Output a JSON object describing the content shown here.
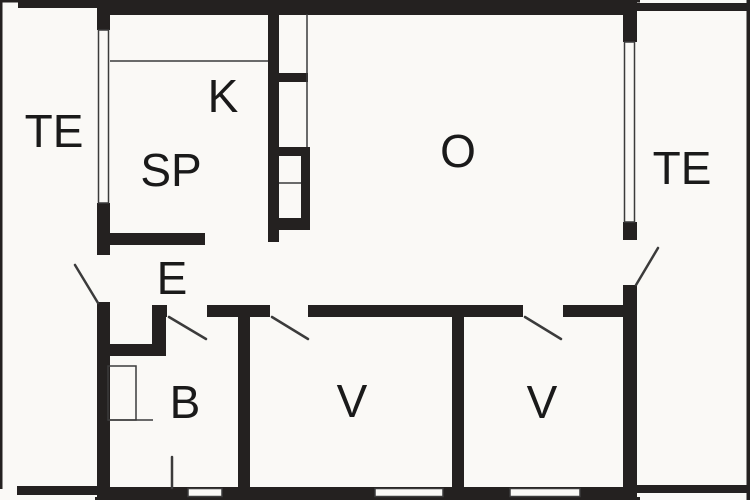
{
  "title": "Floor plan",
  "colors": {
    "background": "#faf9f6",
    "wall": "#242120",
    "line": "#3b3b3b",
    "label": "#1a1a1a"
  },
  "rooms": [
    {
      "id": "terrace-left",
      "label": "TE",
      "x": 54,
      "y": 131
    },
    {
      "id": "kitchen",
      "label": "K",
      "x": 223,
      "y": 96
    },
    {
      "id": "bedroom-sp",
      "label": "SP",
      "x": 171,
      "y": 170
    },
    {
      "id": "living-room",
      "label": "O",
      "x": 458,
      "y": 151
    },
    {
      "id": "terrace-right",
      "label": "TE",
      "x": 682,
      "y": 168
    },
    {
      "id": "entry",
      "label": "E",
      "x": 172,
      "y": 278
    },
    {
      "id": "bathroom",
      "label": "B",
      "x": 185,
      "y": 402
    },
    {
      "id": "bedroom-v1",
      "label": "V",
      "x": 352,
      "y": 401
    },
    {
      "id": "bedroom-v2",
      "label": "V",
      "x": 542,
      "y": 402
    }
  ]
}
